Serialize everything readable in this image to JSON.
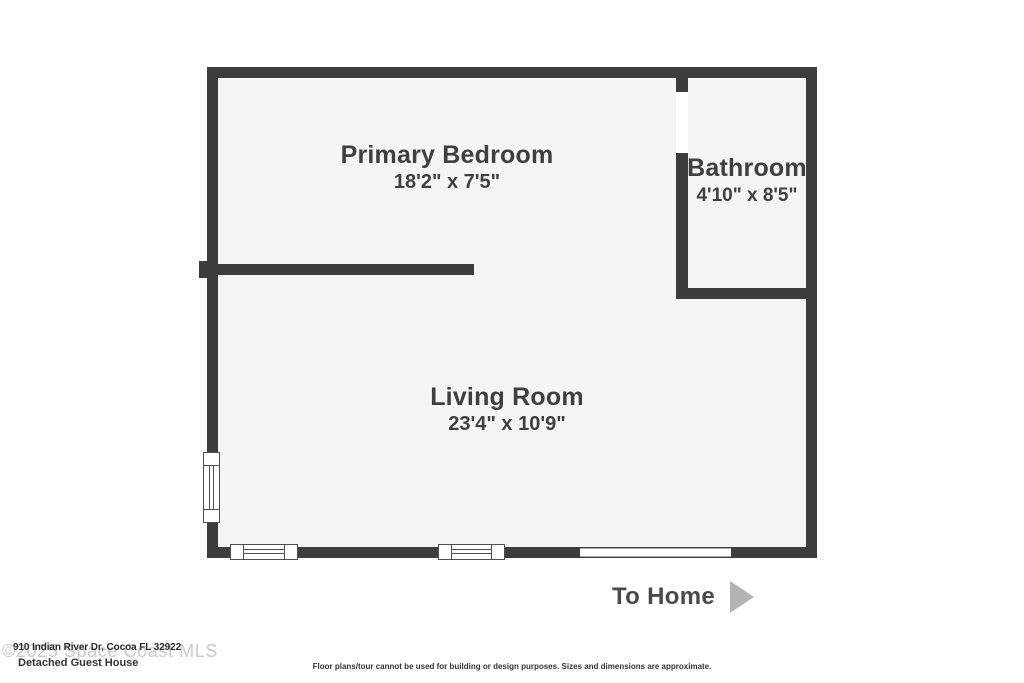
{
  "floor_plan": {
    "rooms": [
      {
        "name": "Primary Bedroom",
        "dimensions": "18'2\" x 7'5\""
      },
      {
        "name": "Bathroom",
        "dimensions": "4'10\" x 8'5\""
      },
      {
        "name": "Living Room",
        "dimensions": "23'4\" x 10'9\""
      }
    ],
    "exit_label": "To Home",
    "colors": {
      "wall": "#3d3d3d",
      "floor": "#f5f5f5",
      "label_text": "#3f3f3f",
      "arrow": "#b3b3b3",
      "watermark_text": "#c9c9c9"
    }
  },
  "footer": {
    "watermark": "©2025 Space Coast MLS",
    "address": "910 Indian River Dr, Cocoa FL 32922",
    "plan_title": "Detached Guest House",
    "disclaimer": "Floor plans/tour cannot be used for building or design purposes. Sizes and dimensions are approximate."
  }
}
